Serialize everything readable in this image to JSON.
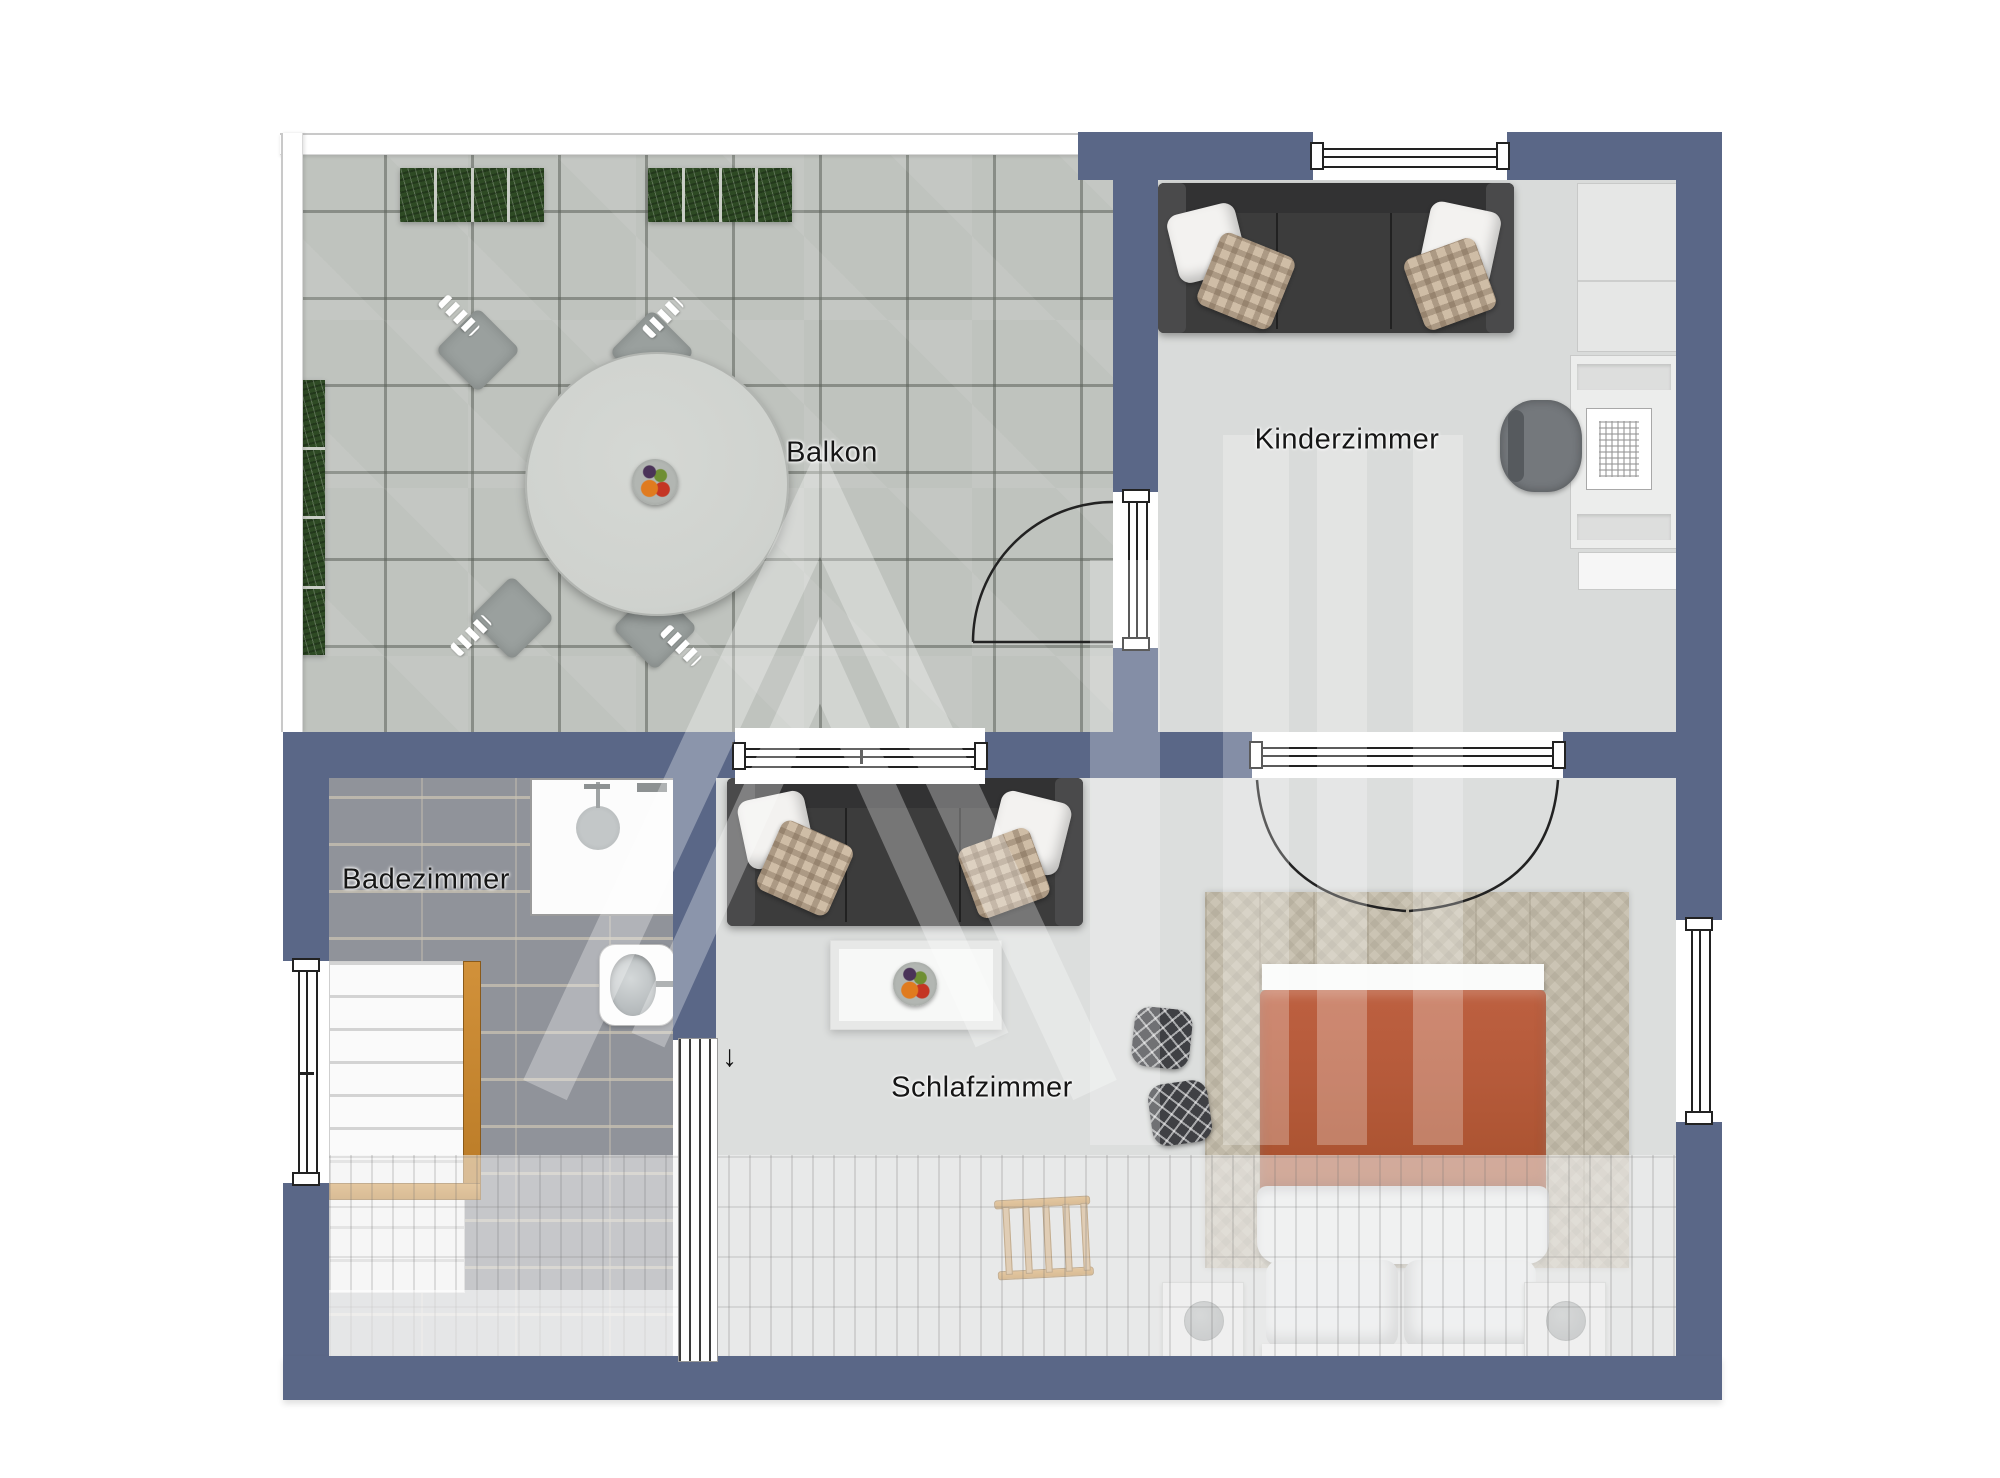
{
  "rooms": {
    "balcony": {
      "label": "Balkon"
    },
    "kids_room": {
      "label": "Kinderzimmer"
    },
    "bathroom": {
      "label": "Badezimmer"
    },
    "bedroom": {
      "label": "Schlafzimmer"
    }
  },
  "annotations": {
    "stairs_direction_arrow": "↓"
  },
  "colors": {
    "wall": "#5a6787",
    "balcony_paving": "#bfc3be",
    "interior_floor": "#dcdedd",
    "kids_floor": "#d9dbda",
    "bathroom_tile": "#90939a",
    "rug": "#cbc4b4",
    "duvet": "#b55a3a",
    "sofa": "#3c3c3c",
    "table": "#cfd2ce",
    "wood": "#c8862e",
    "planter": "#2e4a24",
    "lamp": "#9fa3a4"
  }
}
